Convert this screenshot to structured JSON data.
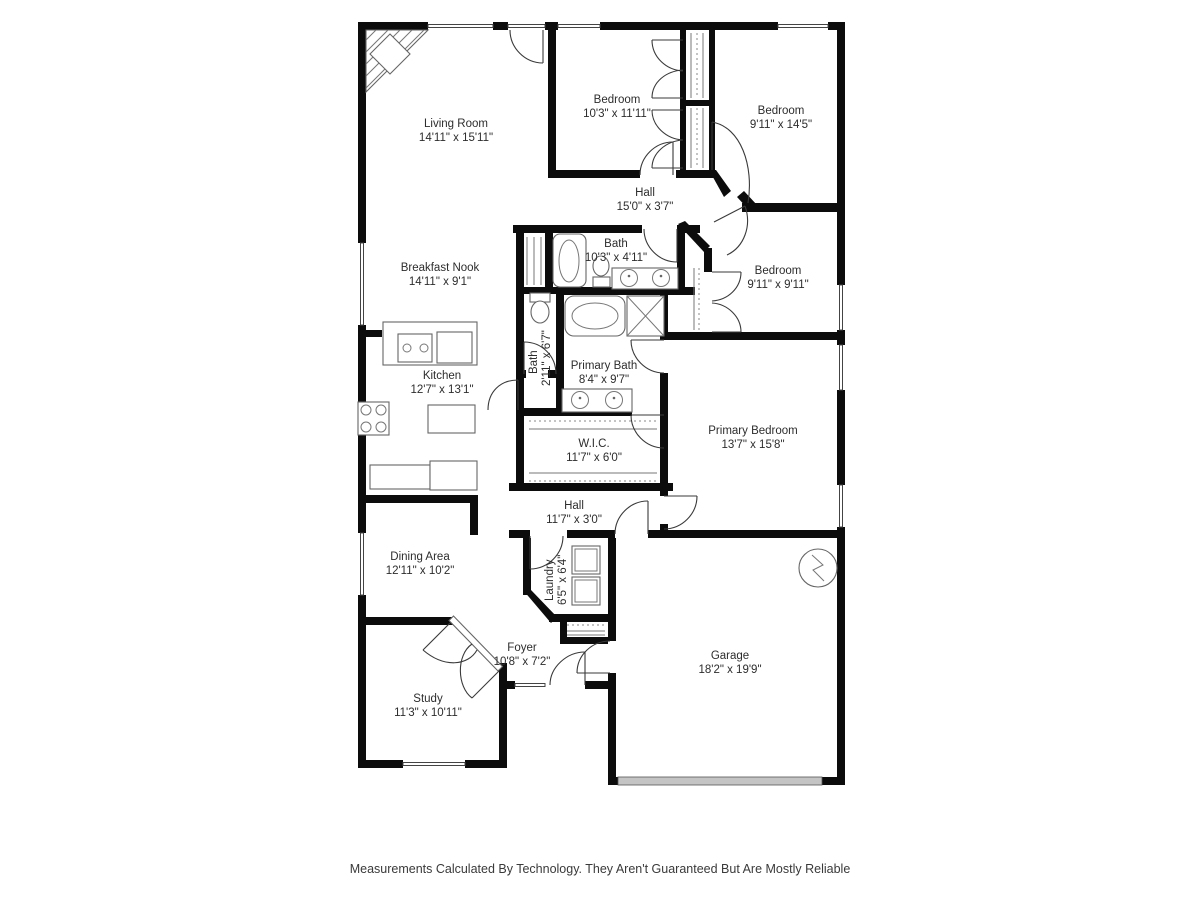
{
  "rooms": {
    "living_room": {
      "name": "Living Room",
      "dims": "14'11\" x 15'11\""
    },
    "bedroom_top": {
      "name": "Bedroom",
      "dims": "10'3\" x 11'11\""
    },
    "bedroom_right": {
      "name": "Bedroom",
      "dims": "9'11\" x 14'5\""
    },
    "hall_top": {
      "name": "Hall",
      "dims": "15'0\" x 3'7\""
    },
    "bath_main": {
      "name": "Bath",
      "dims": "10'3\" x 4'11\""
    },
    "breakfast_nook": {
      "name": "Breakfast Nook",
      "dims": "14'11\" x 9'1\""
    },
    "bedroom_mid": {
      "name": "Bedroom",
      "dims": "9'11\" x 9'11\""
    },
    "bath_half": {
      "name": "Bath",
      "dims": "2'11\" x 6'7\""
    },
    "primary_bath": {
      "name": "Primary Bath",
      "dims": "8'4\" x 9'7\""
    },
    "kitchen": {
      "name": "Kitchen",
      "dims": "12'7\" x 13'1\""
    },
    "primary_bedroom": {
      "name": "Primary Bedroom",
      "dims": "13'7\" x 15'8\""
    },
    "wic": {
      "name": "W.I.C.",
      "dims": "11'7\" x 6'0\""
    },
    "hall_lower": {
      "name": "Hall",
      "dims": "11'7\" x 3'0\""
    },
    "dining_area": {
      "name": "Dining Area",
      "dims": "12'11\" x 10'2\""
    },
    "laundry": {
      "name": "Laundry",
      "dims": "6'5\" x 6'4\""
    },
    "foyer": {
      "name": "Foyer",
      "dims": "10'8\" x 7'2\""
    },
    "garage": {
      "name": "Garage",
      "dims": "18'2\" x 19'9\""
    },
    "study": {
      "name": "Study",
      "dims": "11'3\" x 10'11\""
    }
  },
  "footer": {
    "disclaimer": "Measurements Calculated By Technology. They Aren't Guaranteed But Are Mostly Reliable"
  },
  "symbols": [
    "fireplace",
    "water-heater",
    "washer",
    "dryer",
    "bathtub",
    "shower",
    "toilet",
    "double-vanity",
    "kitchen-island",
    "cooktop",
    "garage-door",
    "closet-rod"
  ],
  "colors": {
    "wall": "#0c0c0c",
    "fixture_line": "#666666",
    "label": "#2d2d2d",
    "garage_door": "#c4c4c4"
  }
}
